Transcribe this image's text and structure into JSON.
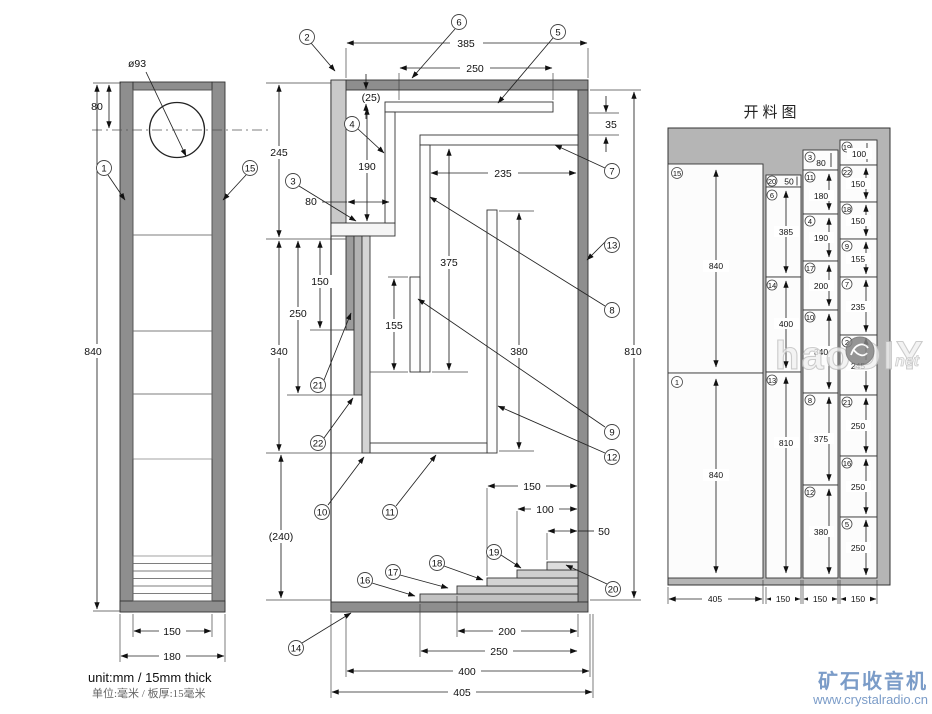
{
  "meta": {
    "unit_note_en": "unit:mm / 15mm thick",
    "unit_note_cn": "单位:毫米 / 板厚:15毫米"
  },
  "branding": {
    "site_name": "矿石收音机",
    "site_url": "www.crystalradio.cn",
    "watermark_text": "haoDIY",
    "watermark_suffix": "net",
    "brand_color": "#7b9cc8"
  },
  "parts": {
    "p1": "1",
    "p2": "2",
    "p3": "3",
    "p4": "4",
    "p5": "5",
    "p6": "6",
    "p7": "7",
    "p8": "8",
    "p9": "9",
    "p10": "10",
    "p11": "11",
    "p12": "12",
    "p13": "13",
    "p14": "14",
    "p15": "15",
    "p16": "16",
    "p17": "17",
    "p18": "18",
    "p19": "19",
    "p20": "20",
    "p21": "21",
    "p22": "22"
  },
  "front_view": {
    "hole_dia": "ø93",
    "hole_offset": "80",
    "height": "840",
    "inner_width": "150",
    "outer_width": "180"
  },
  "section_view": {
    "top_width": "385",
    "shelf5_len": "250",
    "gap_top": "(25)",
    "duct_height": "190",
    "duct_width": "80",
    "mid_width": "235",
    "gap_back": "35",
    "panel8": "375",
    "panel9": "155",
    "panel12": "380",
    "back_height": "810",
    "front_top": "245",
    "front_mid": "340",
    "mouth_height": "(240)",
    "strip21": "250",
    "strip22": "150",
    "step150": "150",
    "step100": "100",
    "step50": "50",
    "step200": "200",
    "step250": "250",
    "bottom_inner": "400",
    "bottom_outer": "405"
  },
  "cutting": {
    "title": "开料图",
    "columns": [
      {
        "bottom_dim": "405",
        "pieces": [
          {
            "n": "15",
            "len": "840"
          },
          {
            "n": "1",
            "len": "840"
          }
        ]
      },
      {
        "bottom_dim": "150",
        "pieces": [
          {
            "n": "20",
            "len": "50"
          },
          {
            "n": "6",
            "len": "385"
          },
          {
            "n": "14",
            "len": "400"
          },
          {
            "n": "13",
            "len": "810"
          }
        ]
      },
      {
        "bottom_dim": "150",
        "pieces": [
          {
            "n": "3",
            "len": "80"
          },
          {
            "n": "11",
            "len": "180"
          },
          {
            "n": "4",
            "len": "190"
          },
          {
            "n": "17",
            "len": "200"
          },
          {
            "n": "10",
            "len": "340"
          },
          {
            "n": "8",
            "len": "375"
          },
          {
            "n": "12",
            "len": "380"
          }
        ]
      },
      {
        "bottom_dim": "150",
        "pieces": [
          {
            "n": "19",
            "len": "100"
          },
          {
            "n": "22",
            "len": "150"
          },
          {
            "n": "18",
            "len": "150"
          },
          {
            "n": "9",
            "len": "155"
          },
          {
            "n": "7",
            "len": "235"
          },
          {
            "n": "2",
            "len": "245"
          },
          {
            "n": "21",
            "len": "250"
          },
          {
            "n": "16",
            "len": "250"
          },
          {
            "n": "5",
            "len": "250"
          }
        ]
      }
    ]
  }
}
